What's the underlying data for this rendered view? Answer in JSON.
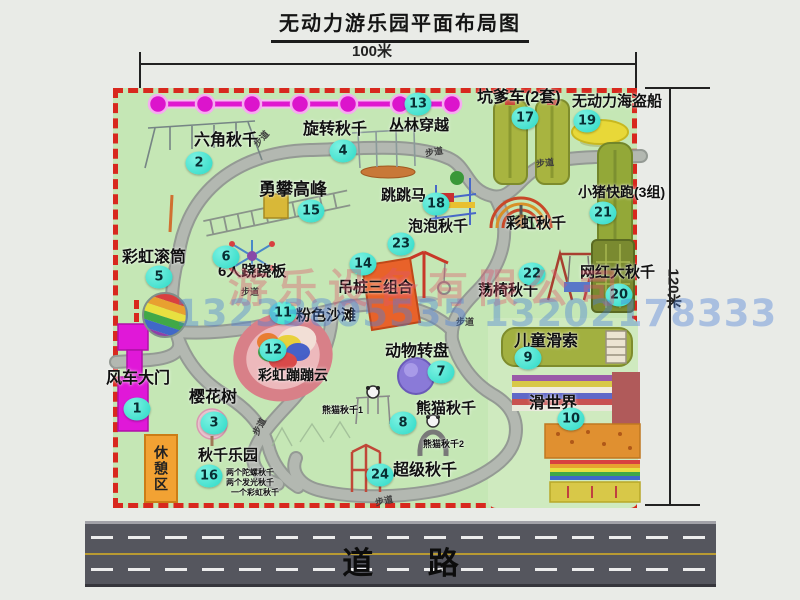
{
  "title": "无动力游乐园平面布局图",
  "dimensions": {
    "width": "100米",
    "height": "120米"
  },
  "road_label": "道 路",
  "trail_label": "步道",
  "rest_area_label": "休憩区",
  "rainbow_swing_label": "彩虹秋千",
  "panda_swing_1": "熊猫秋千1",
  "panda_swing_2": "熊猫秋千2",
  "swing_park_lines": [
    "两个陀螺秋千",
    "两个发光秋千",
    "一个彩虹秋千"
  ],
  "watermark": {
    "company": "游乐设备有限公司",
    "phone": "13233805535 13202178333"
  },
  "attractions": [
    {
      "num": "1",
      "name": "风车大门"
    },
    {
      "num": "2",
      "name": "六角秋千"
    },
    {
      "num": "3",
      "name": "樱花树"
    },
    {
      "num": "4",
      "name": "旋转秋千"
    },
    {
      "num": "5",
      "name": "彩虹滚筒"
    },
    {
      "num": "6",
      "name": "6人跷跷板"
    },
    {
      "num": "7",
      "name": "动物转盘"
    },
    {
      "num": "8",
      "name": "熊猫秋千"
    },
    {
      "num": "9",
      "name": "儿童滑索"
    },
    {
      "num": "10",
      "name": "滑世界"
    },
    {
      "num": "11",
      "name": "粉色沙滩"
    },
    {
      "num": "12",
      "name": "彩虹蹦蹦云"
    },
    {
      "num": "13",
      "name": "丛林穿越"
    },
    {
      "num": "14",
      "name": "吊桩三组合"
    },
    {
      "num": "15",
      "name": "勇攀高峰"
    },
    {
      "num": "16",
      "name": "秋千乐园"
    },
    {
      "num": "17",
      "name": "坑爹车(2套)"
    },
    {
      "num": "18",
      "name": "跳跳马"
    },
    {
      "num": "19",
      "name": "无动力海盗船"
    },
    {
      "num": "20",
      "name": "网红大秋千"
    },
    {
      "num": "21",
      "name": "小猪快跑(3组)"
    },
    {
      "num": "22",
      "name": "荡椅秋千"
    },
    {
      "num": "23",
      "name": "泡泡秋千"
    },
    {
      "num": "24",
      "name": "超级秋千"
    }
  ],
  "colors": {
    "map_green": "#c5e7b5",
    "border_red": "#d8281e",
    "badge_teal": "#2bd9c6",
    "zipline_magenta": "#e018d0",
    "gate_magenta": "#e018d8",
    "rest_orange": "#f2a233",
    "road_gray": "#55565e",
    "road_yellow": "#b89a32"
  }
}
